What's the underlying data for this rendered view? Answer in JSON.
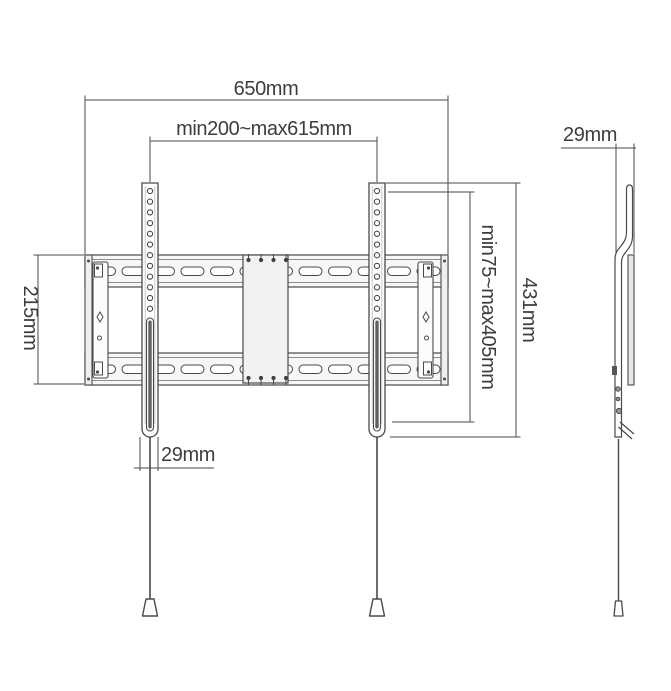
{
  "drawing": {
    "subject": "tv-wall-mount-dimension-drawing",
    "front_view": {
      "label_total_width": "650mm",
      "label_mount_width_range": "min200~max615mm",
      "label_plate_height": "215mm",
      "label_mount_height_range": "min75~max405mm",
      "label_total_height": "431mm",
      "label_arm_width": "29mm"
    },
    "side_view": {
      "label_depth": "29mm"
    },
    "colors": {
      "line": "#4a4a4a",
      "text": "#3d3d3d",
      "rail_fill": "#f7f7f7",
      "vesa_plate_fill": "#f2f2f2",
      "background": "#ffffff"
    }
  }
}
